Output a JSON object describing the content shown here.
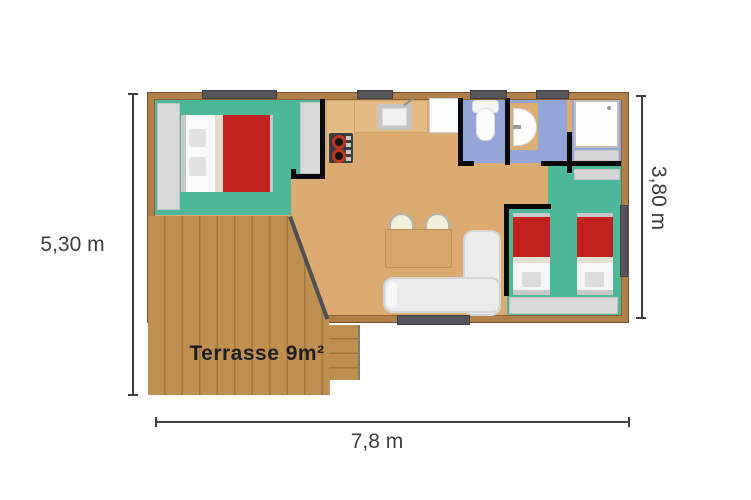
{
  "plan": {
    "type": "floor-plan",
    "unit_rooms": [
      "master-bedroom",
      "kitchen",
      "living-room",
      "bathroom-wc",
      "bathroom-washbasin",
      "shower-room",
      "twin-bedroom",
      "terrace"
    ]
  },
  "annotations": {
    "height_left": "5,30 m",
    "height_right": "3,80 m",
    "width_bottom": "7,8 m"
  },
  "terrace": {
    "label": "Terrasse 9m²",
    "area": "9m²"
  },
  "colors": {
    "wall_wood": "#b28049",
    "floor_tan": "#dcab72",
    "room_teal": "#4cb897",
    "room_blue": "#94a6d8",
    "bed_red": "#c12121",
    "terrace_wood": "#c09052",
    "terrace_plank_line": "#a1773c",
    "window_gray": "#55555a",
    "interior_wall": "#0a0a0a",
    "dimension_text": "#3d3d3d"
  }
}
